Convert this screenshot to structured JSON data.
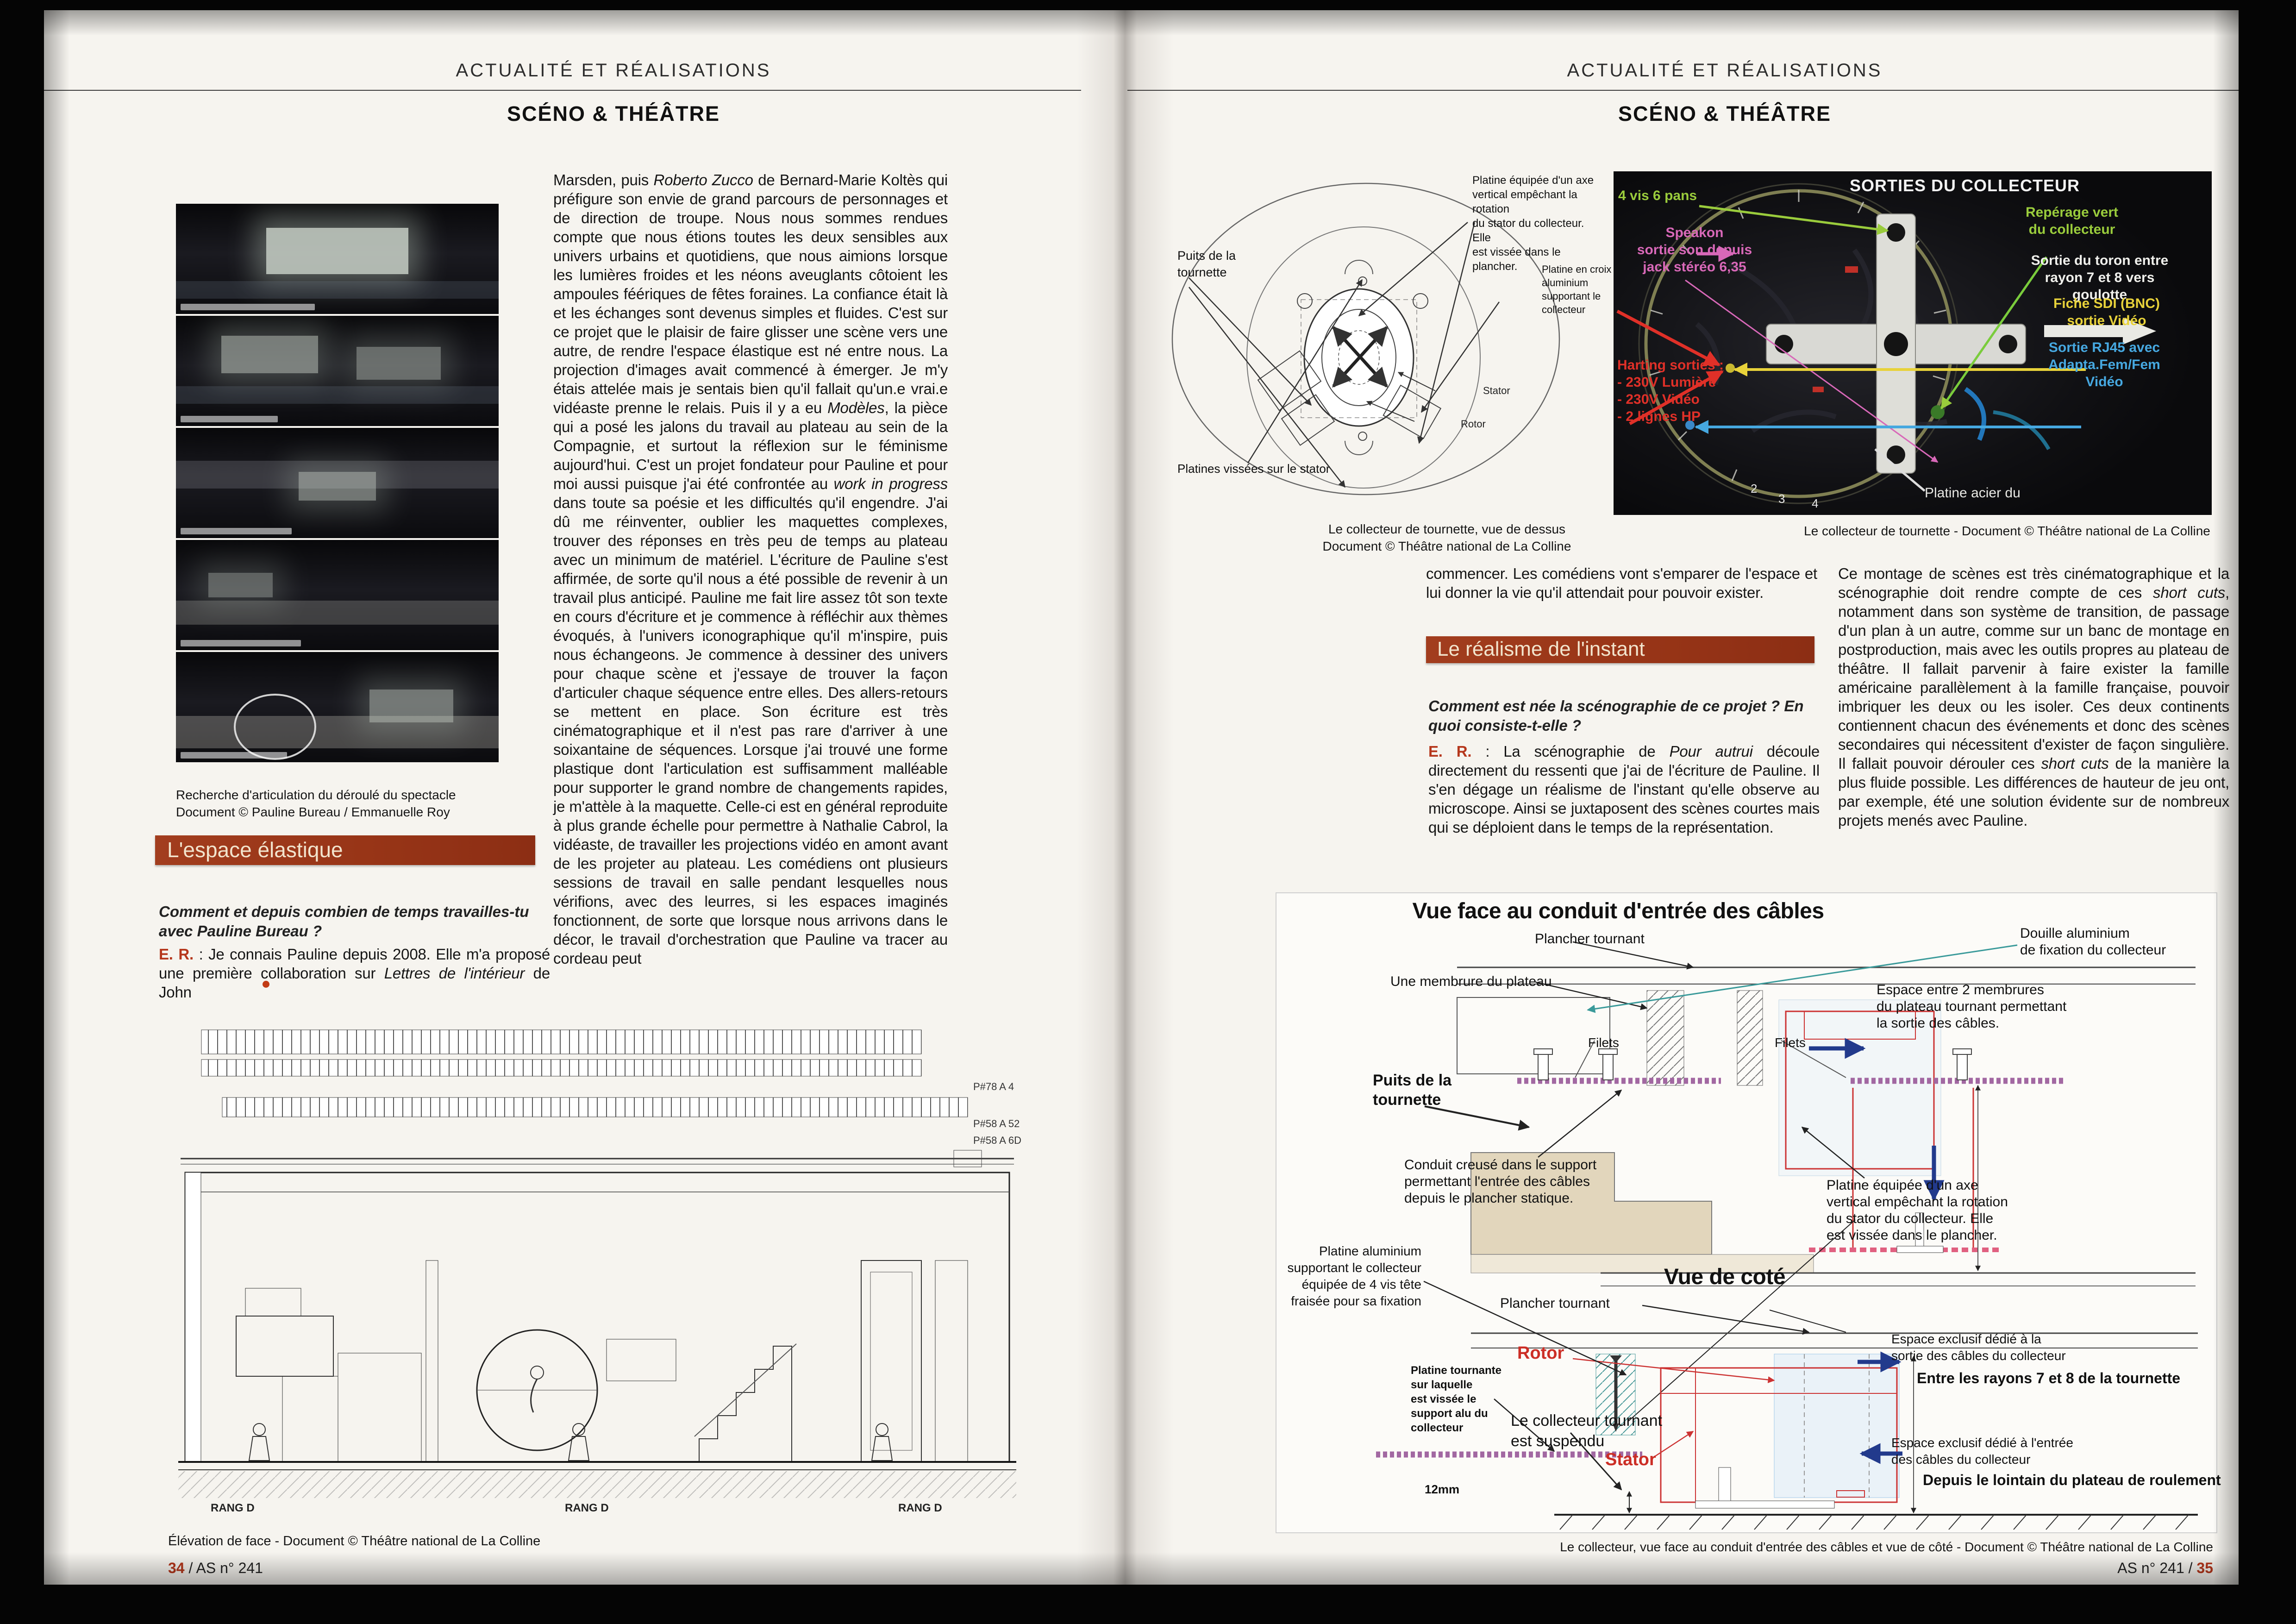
{
  "header": {
    "kicker": "ACTUALITÉ ET RÉALISATIONS",
    "section": "SCÉNO & THÉÂTRE"
  },
  "colors": {
    "accent_bar": "#9c3a1e",
    "speaker_red": "#b5371c",
    "photo_green": "#9acc3c",
    "photo_pink": "#d868b8",
    "photo_red": "#e03028",
    "photo_yellow": "#e8d23a",
    "photo_blue": "#46a8e0"
  },
  "left_page": {
    "photos_caption": "Recherche d'articulation du déroulé du spectacle\nDocument © Pauline Bureau / Emmanuelle Roy",
    "heading": "L'espace élastique",
    "question": "Comment et depuis combien de temps travailles-tu avec Pauline Bureau ?",
    "answer_speaker": "E. R.",
    "answer_s1": " : Je connais Pauline depuis 2008. Elle m'a proposé une première collaboration sur ",
    "answer_i1": "Lettres de l'intérieur",
    "answer_s2": " de John",
    "main_text": {
      "s1": "Marsden, puis ",
      "i1": "Roberto Zucco",
      "s2": " de Bernard-Marie Koltès qui préfigure son envie de grand parcours de personnages et de direction de troupe. Nous nous sommes rendues compte que nous étions toutes les deux sensibles aux univers urbains et quotidiens, que nous aimions lorsque les lumières froides et les néons aveuglants côtoient les ampoules féériques de fêtes foraines. La confiance était là et les échanges sont devenus simples et fluides. C'est sur ce projet que le plaisir de faire glisser une scène vers une autre, de rendre l'espace élastique est né entre nous. La projection d'images avait commencé à émerger. Je m'y étais attelée mais je sentais bien qu'il fallait qu'un.e vrai.e vidéaste prenne le relais. Puis il y a eu ",
      "i2": "Modèles",
      "s3": ", la pièce qui a posé les jalons du travail au plateau au sein de la Compagnie, et surtout la réflexion sur le féminisme aujourd'hui. C'est un projet fondateur pour Pauline et pour moi aussi puisque j'ai été confrontée au ",
      "i3": "work in progress",
      "s4": " dans toute sa poésie et les difficultés qu'il engendre. J'ai dû me réinventer, oublier les maquettes complexes, trouver des réponses en très peu de temps au plateau avec un minimum de matériel. L'écriture de Pauline s'est affirmée, de sorte qu'il nous a été possible de revenir à un travail plus anticipé. Pauline me fait lire assez tôt son texte en cours d'écriture et je commence à réfléchir aux thèmes évoqués, à l'univers iconographique qu'il m'inspire, puis nous échangeons. Je commence à dessiner des univers pour chaque scène et j'essaye de trouver la façon d'articuler chaque séquence entre elles. Des allers-retours se mettent en place. Son écriture est très cinématographique et il n'est pas rare d'arriver à une soixantaine de séquences. Lorsque j'ai trouvé une forme plastique dont l'articulation est suffisamment malléable pour supporter le grand nombre de changements rapides, je m'attèle à la maquette. Celle-ci est en général reproduite à plus grande échelle pour permettre à Nathalie Cabrol, la vidéaste, de travailler les projections vidéo en amont avant de les projeter au plateau. Les comédiens ont plusieurs sessions de travail en salle pendant lesquelles nous vérifions, avec des leurres, si les espaces imaginés fonctionnent, de sorte que lorsque nous arrivons dans le décor, le travail d'orchestration que Pauline va tracer au cordeau peut"
    },
    "drawing": {
      "tag1": "P#78 A 4",
      "tag2": "P#58 A 52",
      "tag3": "P#58 A 6D",
      "rang1": "RANG D",
      "rang2": "RANG D",
      "rang3": "RANG D"
    },
    "drawing_caption": "Élévation de face - Document © Théâtre national de La Colline",
    "footer_page": "34",
    "footer_rest": " / AS n° 241"
  },
  "right_page": {
    "diagram_top": {
      "label_platine_axe": "Platine équipée d'un axe\nvertical empêchant la rotation\ndu stator du collecteur. Elle\nest vissée dans le plancher.",
      "label_puits": "Puits de la\ntournette",
      "label_croix": "Platine en croix\naluminium\nsupportant le\ncollecteur",
      "label_platines_stator": "Platines vissées sur le stator",
      "label_stator": "Stator",
      "label_rotor": "Rotor",
      "caption": "Le collecteur de tournette, vue de dessus\nDocument © Théâtre national de La Colline"
    },
    "photo": {
      "title": "SORTIES DU COLLECTEUR",
      "label_vis": "4 vis 6 pans",
      "label_speakon": "Speakon\nsortie son depuis\njack stéréo 6,35",
      "label_harting": "Harting sorties :\n- 230V Lumière\n- 230V Vidéo\n- 2 lignes HP",
      "label_reperage": "Repérage vert\ndu collecteur",
      "label_toron": "Sortie du toron entre\nrayon 7 et 8 vers\ngoulotte",
      "label_sdi": "Fiche SDI (BNC)\nsortie Vidéo",
      "label_rj45": "Sortie RJ45 avec\nAdapta.Fem/Fem\nVidéo",
      "label_platine_acier": "Platine acier du",
      "rim2": "2",
      "rim3": "3",
      "rim4": "4",
      "caption": "Le collecteur de tournette - Document © Théâtre national de La Colline"
    },
    "intro": "commencer. Les comédiens vont s'emparer de l'espace et lui donner la vie qu'il attendait pour pouvoir exister.",
    "heading": "Le réalisme de l'instant",
    "question": "Comment est née la scénographie de ce projet ? En quoi consiste-t-elle ?",
    "answer_speaker": "E. R.",
    "answer_s1": " : La scénographie de ",
    "answer_i1": "Pour autrui",
    "answer_s2": " découle directement du ressenti que j'ai de l'écriture de Pauline. Il s'en dégage un réalisme de l'instant qu'elle observe au microscope. Ainsi se juxtaposent des scènes courtes mais qui se déploient dans le temps de la représentation.",
    "col2": {
      "s1": "Ce montage de scènes est très cinématographique et la scénographie doit rendre compte de ces ",
      "i1": "short cuts",
      "s2": ", notamment dans son système de transition, de passage d'un plan à un autre, comme sur un banc de montage en postproduction, mais avec les outils propres au plateau de théâtre. Il fallait parvenir à faire exister la famille américaine parallèlement à la famille française, pouvoir imbriquer les deux ou les isoler. Ces deux continents contiennent chacun des événements et donc des scènes secondaires qui nécessitent d'exister de façon singulière. Il fallait pouvoir dérouler ces ",
      "i2": "short cuts",
      "s3": " de la manière la plus fluide possible. Les différences de hauteur de jeu ont, par exemple, été une solution évidente sur de nombreux projets menés avec Pauline."
    },
    "diagram_bottom": {
      "title_face": "Vue face au conduit d'entrée des câbles",
      "title_side": "Vue de coté",
      "label_plancher_tournant_1": "Plancher tournant",
      "label_membrure": "Une membrure du plateau",
      "label_douille": "Douille aluminium\nde fixation du collecteur",
      "label_espace_membrures": "Espace entre 2 membrures\ndu plateau tournant permettant\nla sortie des câbles.",
      "label_filets_1": "Filets",
      "label_filets_2": "Filets",
      "label_puits": "Puits de la\ntournette",
      "label_conduit": "Conduit creusé dans le support\npermettant l'entrée des câbles\ndepuis le plancher statique.",
      "label_platine_axe": "Platine équipée d'un axe\nvertical empêchant la rotation\ndu stator du collecteur. Elle\nest vissée dans le plancher.",
      "label_platine_alu": "Platine aluminium\nsupportant le collecteur\néquipée de 4 vis tête\nfraisée pour sa fixation",
      "label_plancher_tournant_2": "Plancher tournant",
      "label_rotor": "Rotor",
      "label_platine_tournante": "Platine tournante\nsur laquelle\nest vissée le\nsupport alu du\ncollecteur",
      "label_collecteur_suspendu": "Le collecteur tournant\nest suspendu",
      "label_stator": "Stator",
      "label_12mm": "12mm",
      "label_espace_sortie": "Espace exclusif dédié à la\nsortie des câbles du collecteur",
      "label_entre_rayons": "Entre les rayons 7 et 8 de la tournette",
      "label_espace_entree": "Espace exclusif dédié à l'entrée\ndes câbles du collecteur",
      "label_depuis_lointain": "Depuis le lointain du plateau de roulement",
      "caption": "Le collecteur, vue face au conduit d'entrée des câbles et vue de côté - Document © Théâtre national de La Colline"
    },
    "footer_rest": "AS n° 241 / ",
    "footer_page": "35"
  }
}
